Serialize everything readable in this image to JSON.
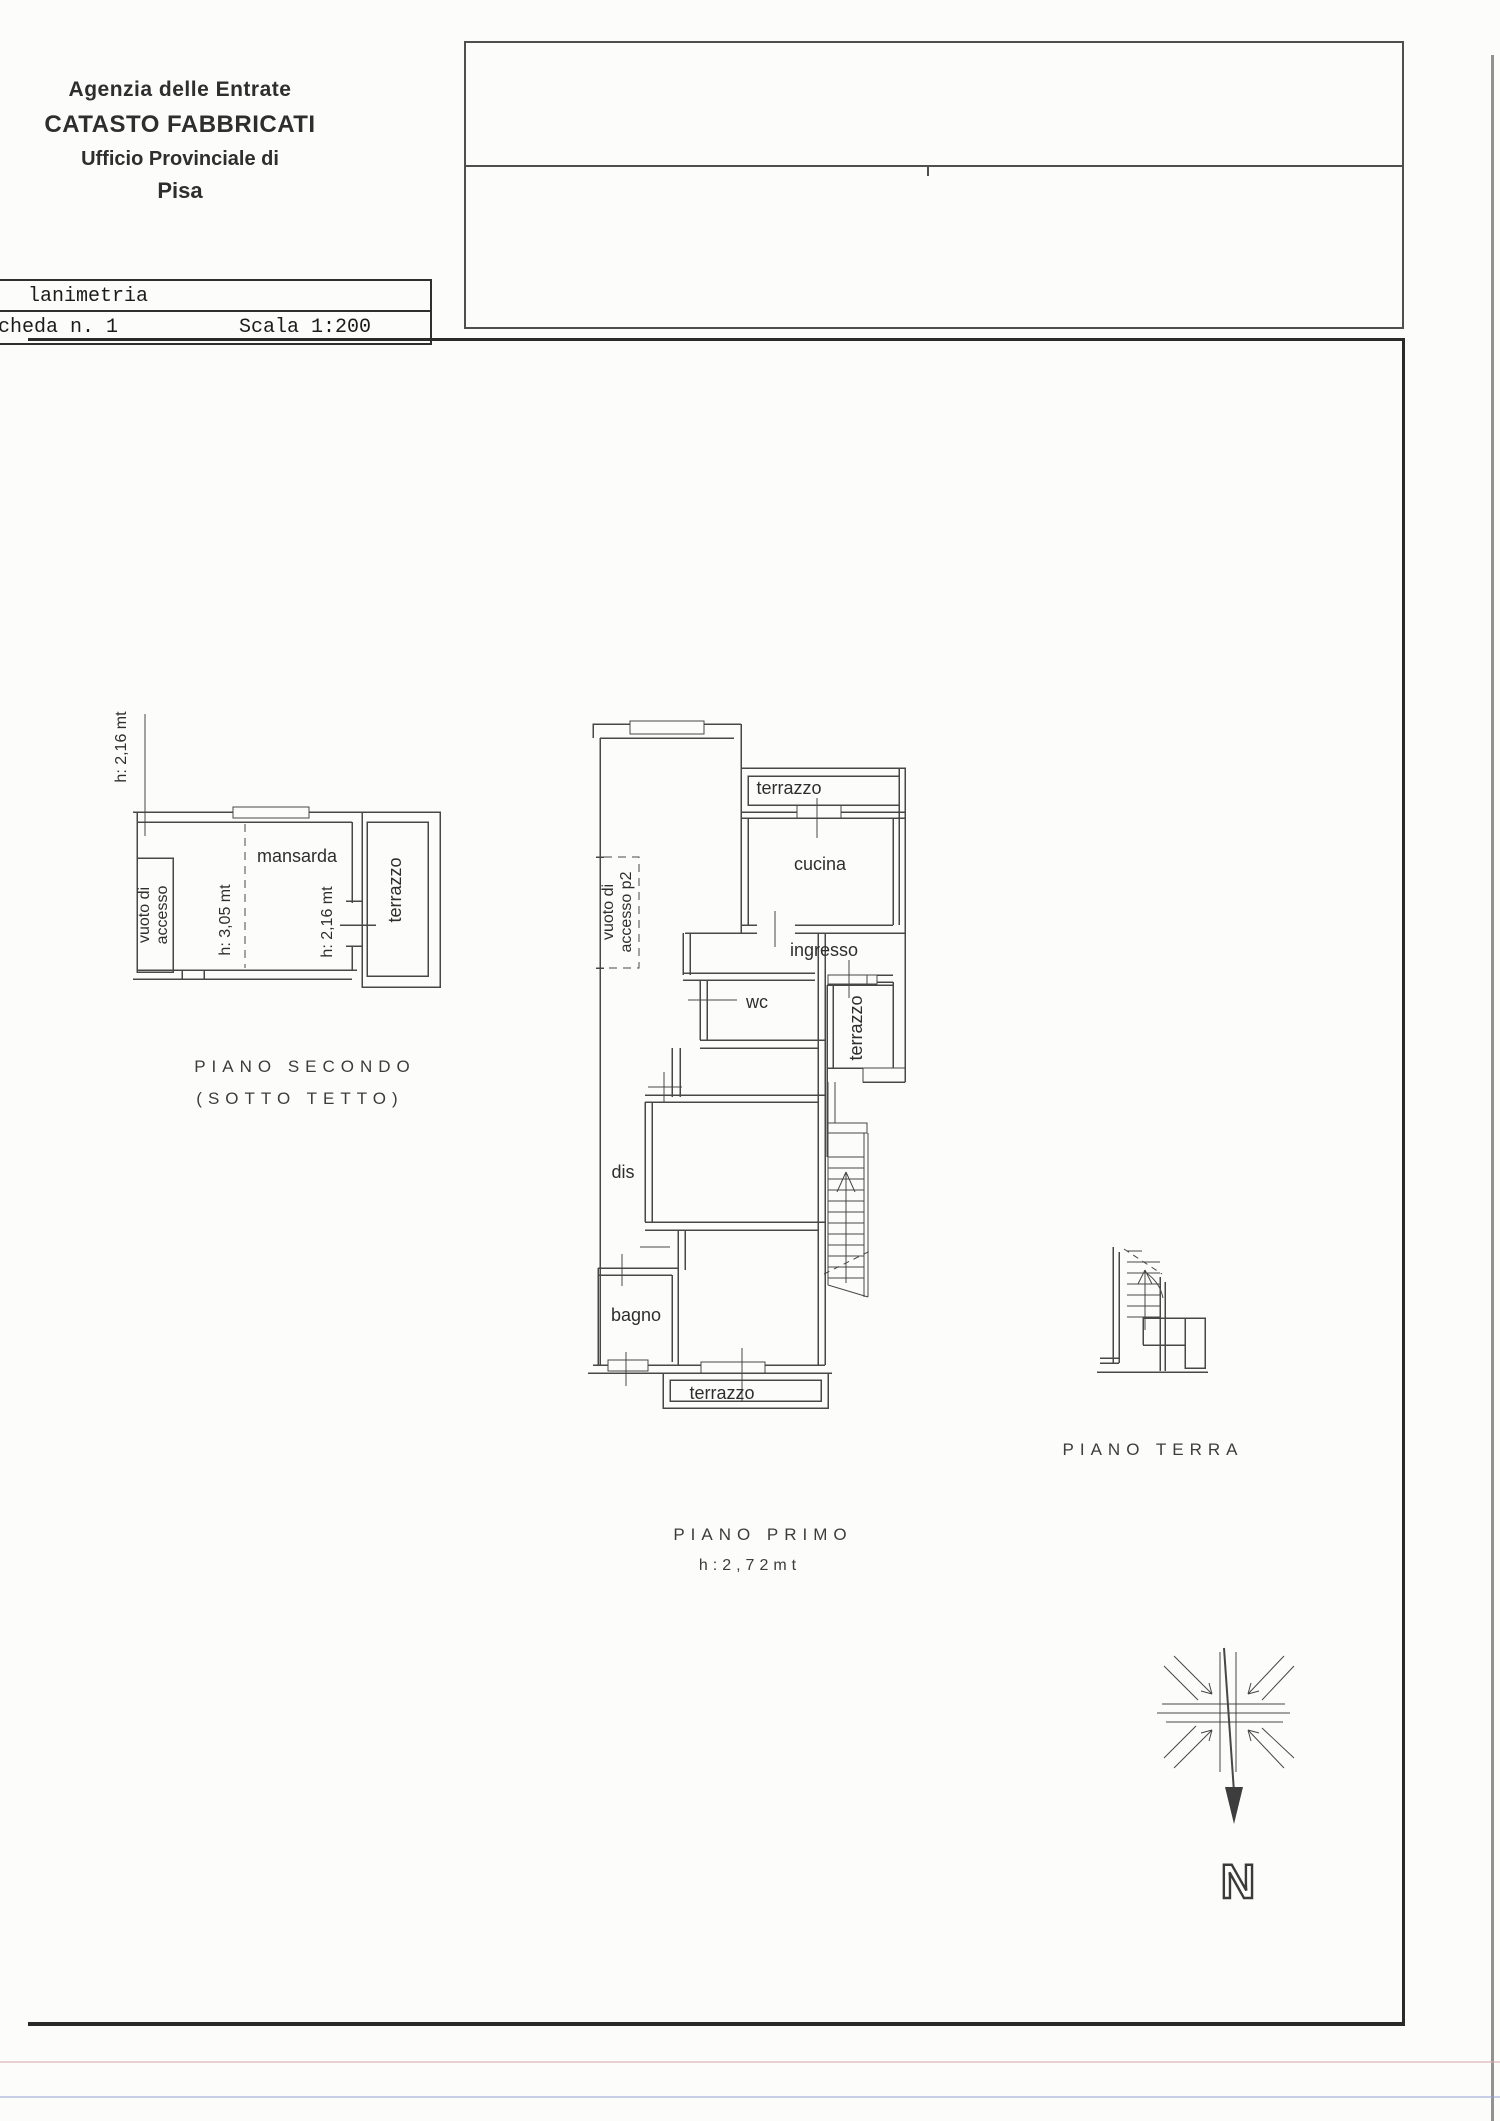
{
  "header": {
    "line1": "Agenzia delle Entrate",
    "line2": "CATASTO FABBRICATI",
    "line3": "Ufficio Provinciale di",
    "line4": "Pisa"
  },
  "stamp": {
    "row1": "lanimetria",
    "sheet": "cheda n. 1",
    "scale": "Scala 1:200"
  },
  "piano_secondo": {
    "title": "PIANO SECONDO",
    "subtitle": "(SOTTO TETTO)",
    "height_left": "h: 2,16 mt",
    "height_mid": "h: 3,05 mt",
    "height_right": "h: 2,16 mt",
    "room_mansarda": "mansarda",
    "room_terrazzo": "terrazzo",
    "vuoto_line1": "vuoto di",
    "vuoto_line2": "accesso"
  },
  "piano_primo": {
    "title": "PIANO PRIMO",
    "height_note": "h:2,72mt",
    "room_terrazzo_top": "terrazzo",
    "room_cucina": "cucina",
    "room_ingresso": "ingresso",
    "room_wc": "wc",
    "room_terrazzo_right": "terrazzo",
    "room_dis": "dis",
    "room_bagno": "bagno",
    "room_terrazzo_bottom": "terrazzo",
    "vuoto_line1": "vuoto di",
    "vuoto_line2": "accesso p2"
  },
  "piano_terra": {
    "title": "PIANO TERRA"
  },
  "compass": {
    "north_label": "N"
  },
  "colors": {
    "plan_line": "#474747",
    "border": "#2a2a2a",
    "text": "#2e2e2e"
  }
}
